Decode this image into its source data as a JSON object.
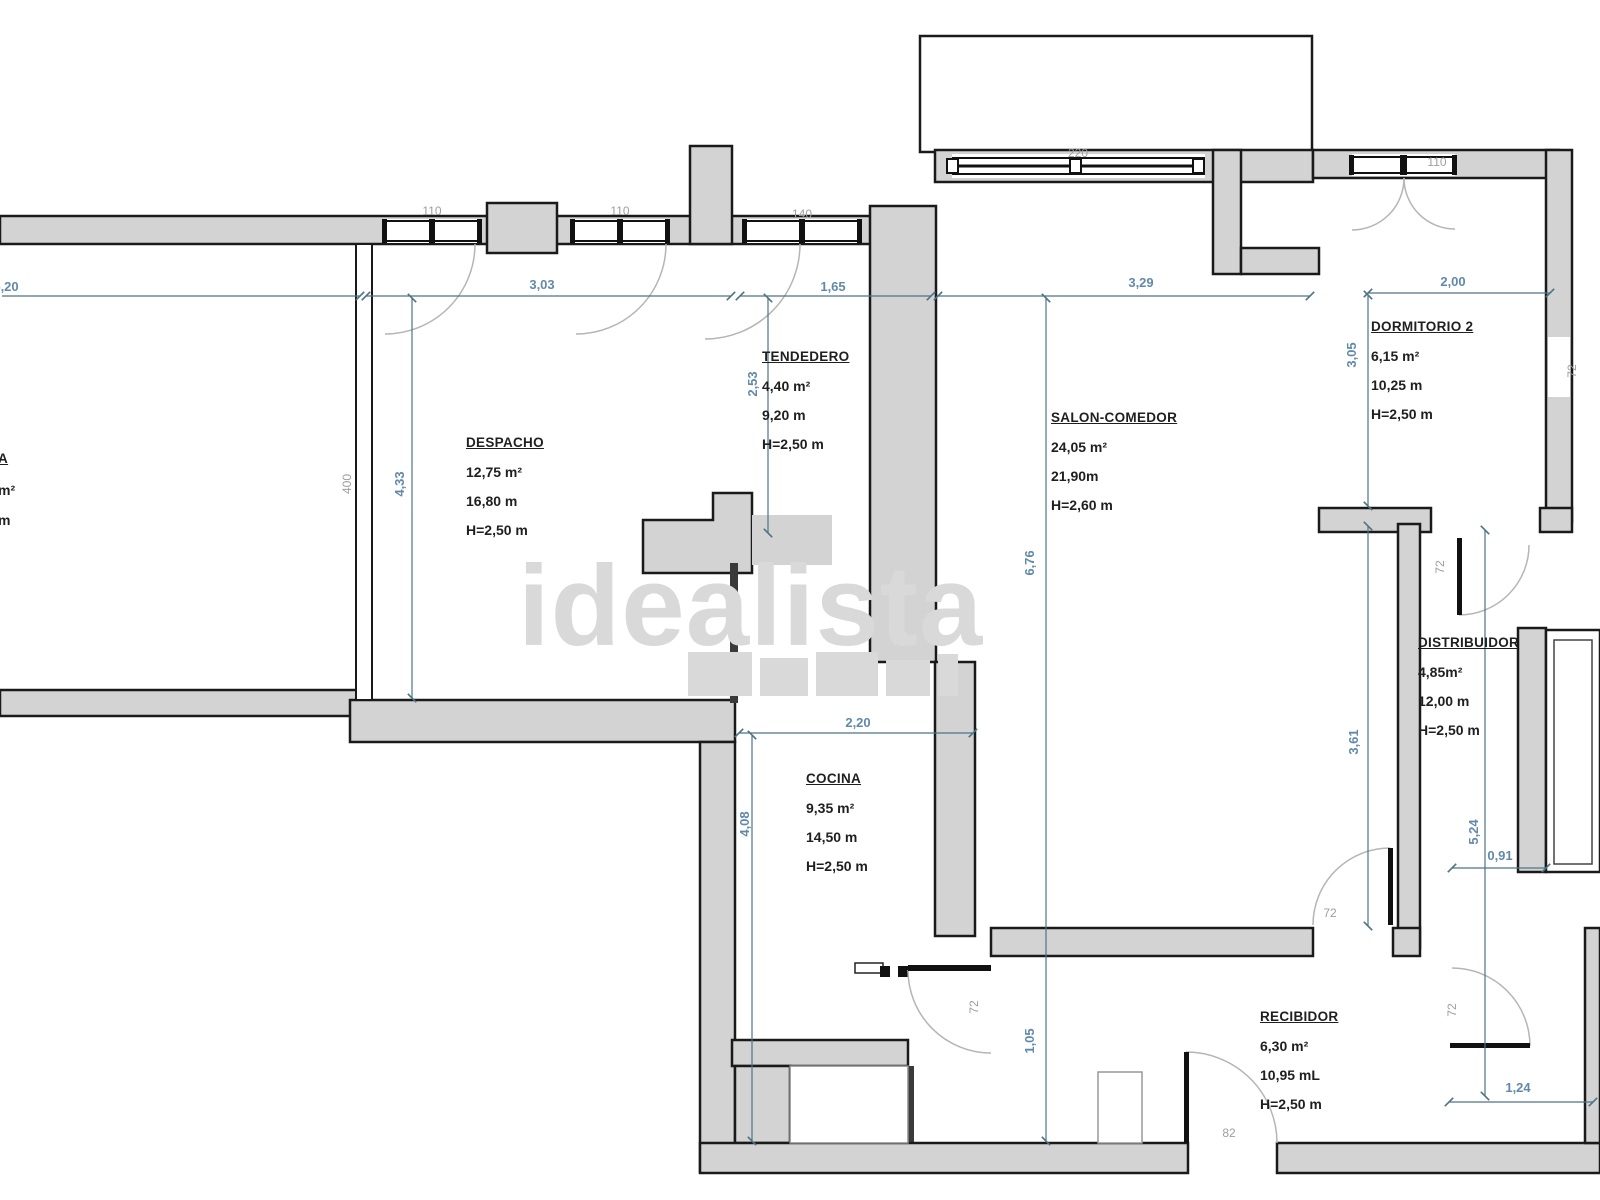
{
  "watermark": {
    "text": "idealista"
  },
  "rooms": [
    {
      "name": "DESPACHO",
      "area": "12,75 m²",
      "perimeter": "16,80 m",
      "height": "H=2,50 m"
    },
    {
      "name": "TENDEDERO",
      "area": "4,40 m²",
      "perimeter": "9,20 m",
      "height": "H=2,50 m"
    },
    {
      "name": "SALON-COMEDOR",
      "area": "24,05 m²",
      "perimeter": "21,90m",
      "height": "H=2,60 m"
    },
    {
      "name": "DORMITORIO 2",
      "area": "6,15 m²",
      "perimeter": "10,25 m",
      "height": "H=2,50 m"
    },
    {
      "name": "DISTRIBUIDOR",
      "area": "4,85m²",
      "perimeter": "12,00 m",
      "height": "H=2,50 m"
    },
    {
      "name": "COCINA",
      "area": "9,35 m²",
      "perimeter": "14,50 m",
      "height": "H=2,50 m"
    },
    {
      "name": "RECIBIDOR",
      "area": "6,30 m²",
      "perimeter": "10,95 mL",
      "height": "H=2,50 m"
    }
  ],
  "partial_room": {
    "name": "A",
    "area": "m²",
    "perimeter": "m"
  },
  "dims": [
    {
      "text": "5,20"
    },
    {
      "text": "3,03"
    },
    {
      "text": "1,65"
    },
    {
      "text": "3,29"
    },
    {
      "text": "2,00"
    },
    {
      "text": "2,20"
    },
    {
      "text": "4,33"
    },
    {
      "text": "2,53"
    },
    {
      "text": "6,76"
    },
    {
      "text": "3,05"
    },
    {
      "text": "3,61"
    },
    {
      "text": "5,24"
    },
    {
      "text": "0,91"
    },
    {
      "text": "4,08"
    },
    {
      "text": "1,05"
    },
    {
      "text": "1,24"
    }
  ],
  "labels": [
    {
      "text": "110"
    },
    {
      "text": "110"
    },
    {
      "text": "140"
    },
    {
      "text": "220"
    },
    {
      "text": "110"
    },
    {
      "text": "400"
    },
    {
      "text": "72"
    },
    {
      "text": "72"
    },
    {
      "text": "82"
    },
    {
      "text": "72"
    },
    {
      "text": "72"
    },
    {
      "text": "72"
    }
  ],
  "colors": {
    "wall_fill": "#d3d3d3",
    "wall_stroke": "#1a1a1a",
    "dim_line": "#4e7486",
    "dim_text": "#6289ab",
    "door_label": "#9e9e9e",
    "room_text": "#1f1f1f",
    "watermark": "#d9d9d9"
  }
}
